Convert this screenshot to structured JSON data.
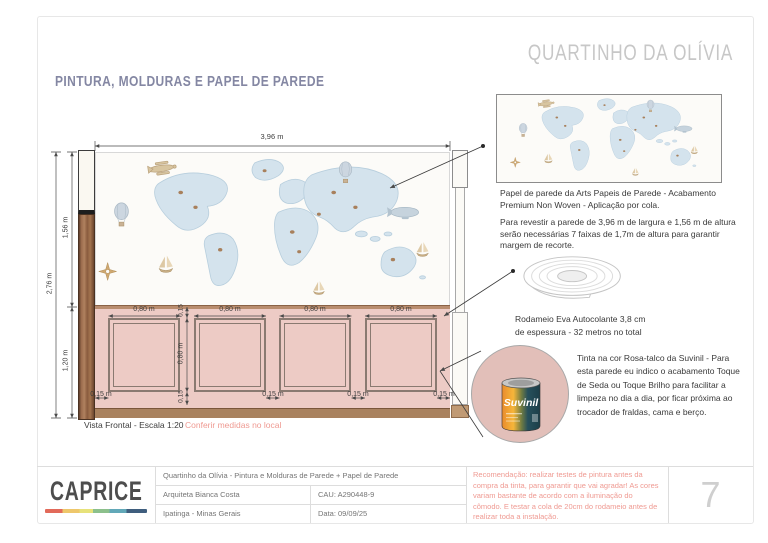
{
  "page": {
    "title": "QUARTINHO DA OLÍVIA",
    "section_title": "PINTURA, MOLDURAS E PAPEL DE PAREDE",
    "page_number": "7"
  },
  "drawing": {
    "caption": "Vista Frontal - Escala 1:20",
    "caption_note": "Conferir medidas no local",
    "dims": {
      "total_width": "3,96 m",
      "total_height": "2,76 m",
      "wallpaper_height": "1,56 m",
      "wainscot_height": "1,20 m",
      "panel_widths": [
        "0,80 m",
        "0,80 m",
        "0,80 m",
        "0,80 m"
      ],
      "panel_height": "0,80 m",
      "gap_top": "0,15",
      "gap_bottom": "0,15",
      "bottom_margins": [
        "0,15 m",
        "0,15 m",
        "0,15 m",
        "0,15 m"
      ]
    }
  },
  "sidebar": {
    "map_illustration": "world-map-wallpaper-illustration",
    "wallpaper_caption": "Papel de parede da Arts Papeis de Parede - Acabamento Premium Non Woven - Aplicação por cola.",
    "wallpaper_note": "Para revestir a parede de 3,96 m de largura e 1,56 m de altura serão necessárias 7 faixas de 1,7m de altura para garantir margem de recorte.",
    "rodameio_illustration": "eva-trim-roll-illustration",
    "rodameio_caption_line1": "Rodameio Eva Autocolante 3,8 cm",
    "rodameio_caption_line2": "de espessura - 32 metros no total",
    "paint_swatch": "rosa-talco-color-swatch",
    "paint_brand": "Suvinil",
    "paint_note": "Tinta na cor Rosa-talco da Suvinil - Para esta parede eu indico o acabamento Toque de Seda ou Toque Brilho para facilitar a limpeza no dia a dia, por ficar próxima ao trocador de fraldas, cama e berço."
  },
  "footer": {
    "logo": "CAPRICE",
    "project": "Quartinho da Olívia - Pintura e Molduras de Parede + Papel de Parede",
    "architect": "Arquiteta Bianca Costa",
    "cau": "CAU: A290448-9",
    "city": "Ipatinga - Minas Gerais",
    "date": "Data: 09/09/25",
    "recommendation": "Recomendação: realizar testes de pintura antes da compra da tinta, para garantir que vai agradar! As cores variam bastante de acordo com a iluminação do cômodo. E testar a cola de 20cm do rodameio antes de realizar toda a instalação."
  },
  "colors": {
    "rosa_talco": "#e2bfb9",
    "wainscot_pink": "#edcbc5",
    "wood_brown": "#9a6b4c",
    "accent_salmon": "#ef9a92",
    "title_gray": "#c7c7c7",
    "section_purple": "#8487a3"
  }
}
